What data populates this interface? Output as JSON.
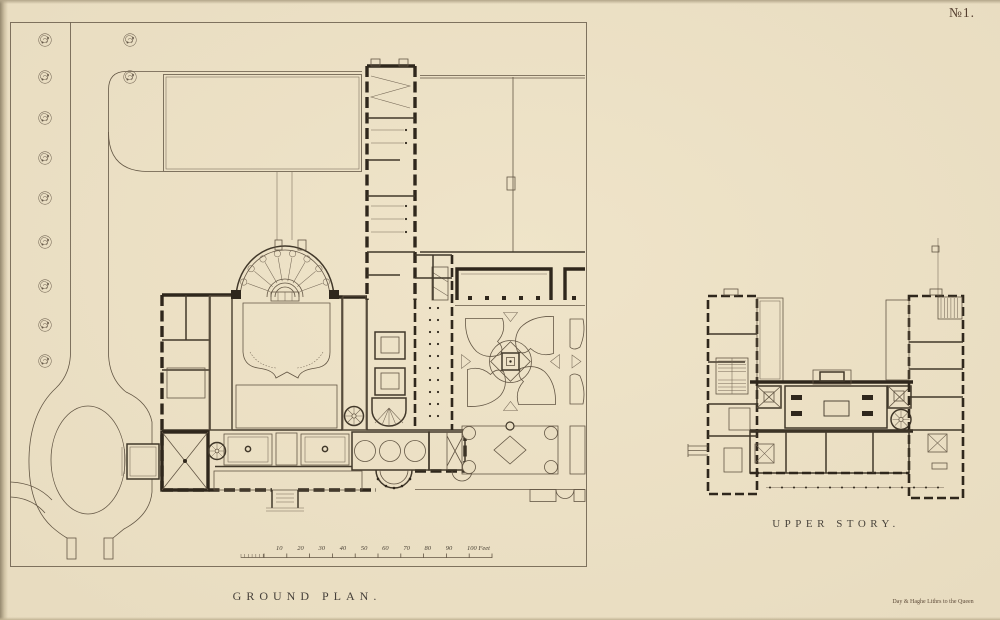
{
  "page": {
    "plate_number": "№1.",
    "credit": "Day & Haghe Lithrs to the Queen",
    "colors": {
      "paper": "#e9ddc1",
      "ink": "#241c12",
      "line": "#5b4e3d"
    }
  },
  "ground_plan": {
    "title": "GROUND PLAN.",
    "scale_bar": {
      "unit_labels": [
        "10",
        "20",
        "30",
        "40",
        "50",
        "60",
        "70",
        "80",
        "90"
      ],
      "end_label": "100 Feet"
    }
  },
  "upper_story": {
    "title": "UPPER STORY."
  }
}
